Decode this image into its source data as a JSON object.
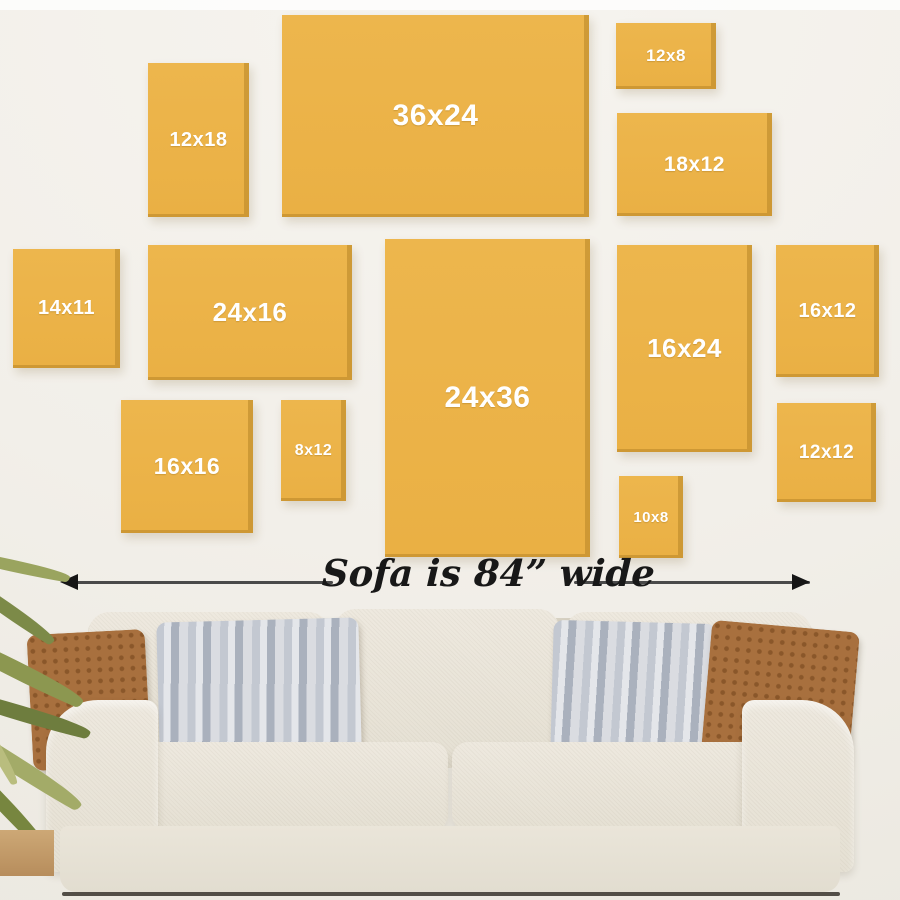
{
  "frames": [
    {
      "label": "12x18"
    },
    {
      "label": "36x24"
    },
    {
      "label": "12x8"
    },
    {
      "label": "18x12"
    },
    {
      "label": "14x11"
    },
    {
      "label": "24x16"
    },
    {
      "label": "24x36"
    },
    {
      "label": "16x24"
    },
    {
      "label": "16x12"
    },
    {
      "label": "16x16"
    },
    {
      "label": "8x12"
    },
    {
      "label": "10x8"
    },
    {
      "label": "12x12"
    }
  ],
  "dimension": {
    "label": "Sofa is 84” wide"
  },
  "colors": {
    "frame_yellow": "#ECB44A",
    "frame_edge_shadow": "#BA882A",
    "frame_label_text": "#FFFFFF",
    "wall": "#F2EFE9",
    "arrow": "#2A2A2A",
    "sofa_fabric": "#EAE5DA",
    "pillow_brown": "#A8703E",
    "pillow_gray": "#C6CBD4",
    "plant_green": "#8B9750",
    "floor_tan": "#C7A171"
  }
}
